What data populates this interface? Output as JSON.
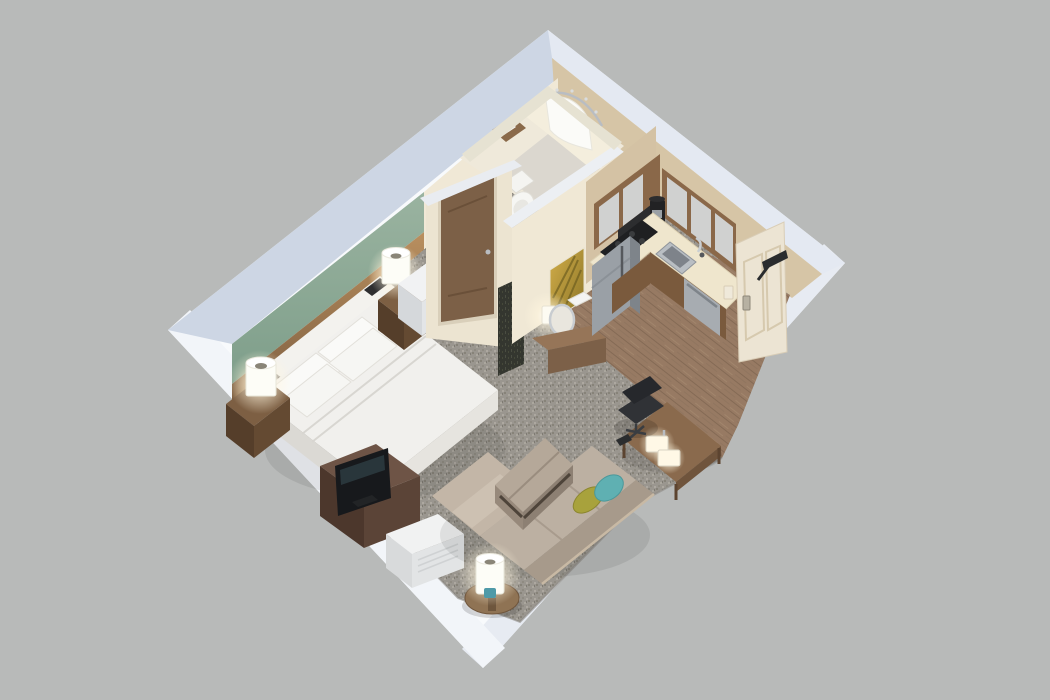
{
  "scene": {
    "title": "isometric-3d-cutaway-floor-plan-studio-suite",
    "description": "3D isometric cutaway rendering of a studio hotel suite floor plan with bedroom, living area, kitchen, bathroom and entry",
    "rooms": [
      "bedroom",
      "living-area",
      "kitchen",
      "bathroom",
      "entry-hall",
      "dressing-nook"
    ],
    "objects": [
      "king-bed",
      "bed-pillows",
      "headboard-wall",
      "nightstand-left",
      "nightstand-right",
      "table-lamp-left",
      "table-lamp-right",
      "wardrobe-cabinet",
      "tv-dresser",
      "television",
      "ptac-air-unit",
      "sectional-sofa",
      "chaise",
      "throw-pillow-olive",
      "throw-pillow-teal",
      "ottoman-bench",
      "round-side-table",
      "cylinder-lamp",
      "work-desk",
      "desk-lamp",
      "office-chair",
      "remote-control",
      "dressing-console",
      "round-mirror",
      "console-lamp",
      "wall-art-gold-palm",
      "decor-panel",
      "bathroom-door",
      "toilet",
      "shower",
      "shower-curtain",
      "shower-rod",
      "towel-shelf",
      "upper-cabinets",
      "kitchen-counter",
      "cooktop",
      "sink",
      "faucet",
      "refrigerator",
      "dishwasher",
      "base-cabinets",
      "coffee-maker",
      "range-hood",
      "entry-door",
      "door-closer",
      "light-switch"
    ]
  },
  "colors": {
    "background": "#b8bab9",
    "wall_white": "#f8fafc",
    "wall_top_nw": "#cdd6e4",
    "wall_top_ne": "#e4e9f2",
    "wall_outer_se": "#e7ebf2",
    "wall_outer_sw": "#f2f5f9",
    "block_top": "#e9ecf1",
    "green_accent_light": "#9ab3a0",
    "green_accent_dark": "#7e9e8a",
    "headboard_wood_lit": "#b98f5f",
    "headboard_wood_dark": "#7a5c3f",
    "cream_wall": "#f0e8d6",
    "tan_wall": "#d6c5a6",
    "carpet": "#9a968f",
    "wood_floor": "#977a63",
    "bath_tile": "#dbd7cf",
    "bath_enclosure": "#efe9da",
    "mattress": "#f1f0ed",
    "pillow_white": "#fafaf8",
    "sofa": "#bcb0a2",
    "sofa_back": "#a79a8b",
    "ottoman": "#b5a899",
    "pillow_olive": "#a8a23c",
    "pillow_teal": "#5fb0b2",
    "dresser_wood": "#6e5446",
    "tv_black": "#17191c",
    "ptac_white": "#f1f2f2",
    "counter_cream": "#efe6cd",
    "cabinet_wood": "#8a6849",
    "base_cabinet_wood": "#7a5a3d",
    "stainless": "#9aa0a6",
    "stainless_light": "#a7acb1",
    "door_cream": "#ece4d3",
    "bath_door_brown": "#7c6047",
    "art_gold": "#c5a43d",
    "console_wood": "#967558",
    "glow_warm": "#ffd9a0",
    "lamp_white": "#fdfdf7",
    "chair_black": "#303236",
    "panel_dark": "#34362f"
  }
}
